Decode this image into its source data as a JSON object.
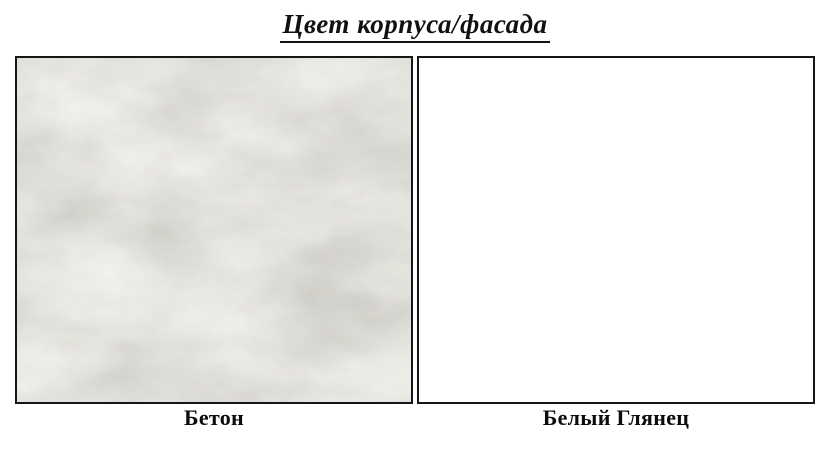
{
  "title": "Цвет корпуса/фасада",
  "swatches": [
    {
      "label": "Бетон",
      "kind": "concrete-texture",
      "base_color": "#d6d2cb",
      "light_tone": "#dedbd5",
      "dark_tone": "#a9a399"
    },
    {
      "label": "Белый Глянец",
      "kind": "solid",
      "color": "#ffffff"
    }
  ],
  "border_color": "#161616"
}
